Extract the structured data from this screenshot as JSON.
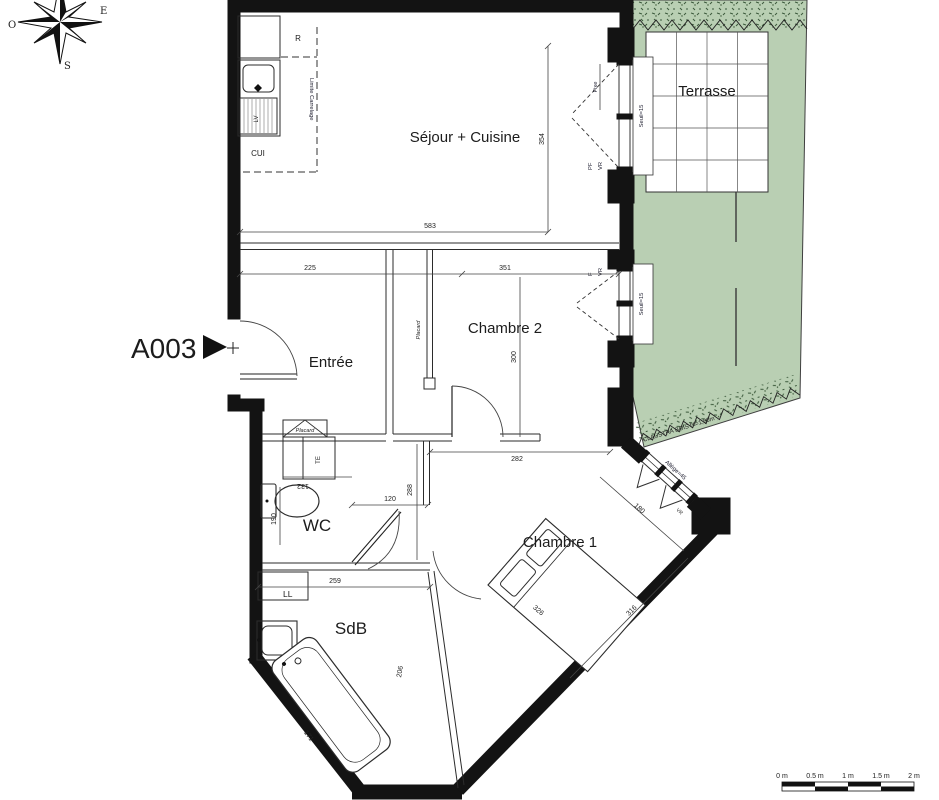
{
  "plan": {
    "unit_label": "A003",
    "compass": {
      "west": "O",
      "east": "E",
      "south": "S"
    },
    "rooms": {
      "sejour": "Séjour + Cuisine",
      "terrasse": "Terrasse",
      "chambre2": "Chambre 2",
      "entree": "Entrée",
      "wc": "WC",
      "chambre1": "Chambre 1",
      "sdb": "SdB"
    },
    "fixtures": {
      "fridge": "R",
      "cooktop": "CUI",
      "dishwasher": "LV",
      "washer": "LL",
      "elec_panel": "TE",
      "placard_entree": "Placard",
      "placard_ch2": "Placard"
    },
    "annotations": {
      "limite_carrelage": "Limite Carrelage",
      "fixe": "Fixe",
      "pf": "PF",
      "vr_sejour": "VR",
      "f_ch2": "F",
      "vr_ch2": "VR",
      "seuil_sejour": "Seuil=15",
      "seuil_ch2": "Seuil=15",
      "allege_ch1": "Allège=45",
      "vr_ch1": "VR",
      "claustra": "CLAUSTRA BOIS ht=1,80m"
    },
    "dimensions": {
      "sejour_w": "583",
      "sejour_h": "354",
      "entree_w": "225",
      "ch2_w": "351",
      "ch2_h": "300",
      "ch2_bottom": "282",
      "corridor_h": "288",
      "wc_top": "132",
      "wc_left": "190",
      "wc_door": "120",
      "wc_bottom": "259",
      "ch1_window": "180",
      "ch1_side": "316",
      "ch1_width": "326",
      "tub_len": "171",
      "sdb_diag": "206"
    },
    "scalebar": {
      "t0": "0 m",
      "t05": "0.5 m",
      "t1": "1 m",
      "t15": "1.5 m",
      "t2": "2 m"
    },
    "colors": {
      "garden": "#b9cfb3",
      "wall": "#141414",
      "line": "#333333"
    }
  }
}
